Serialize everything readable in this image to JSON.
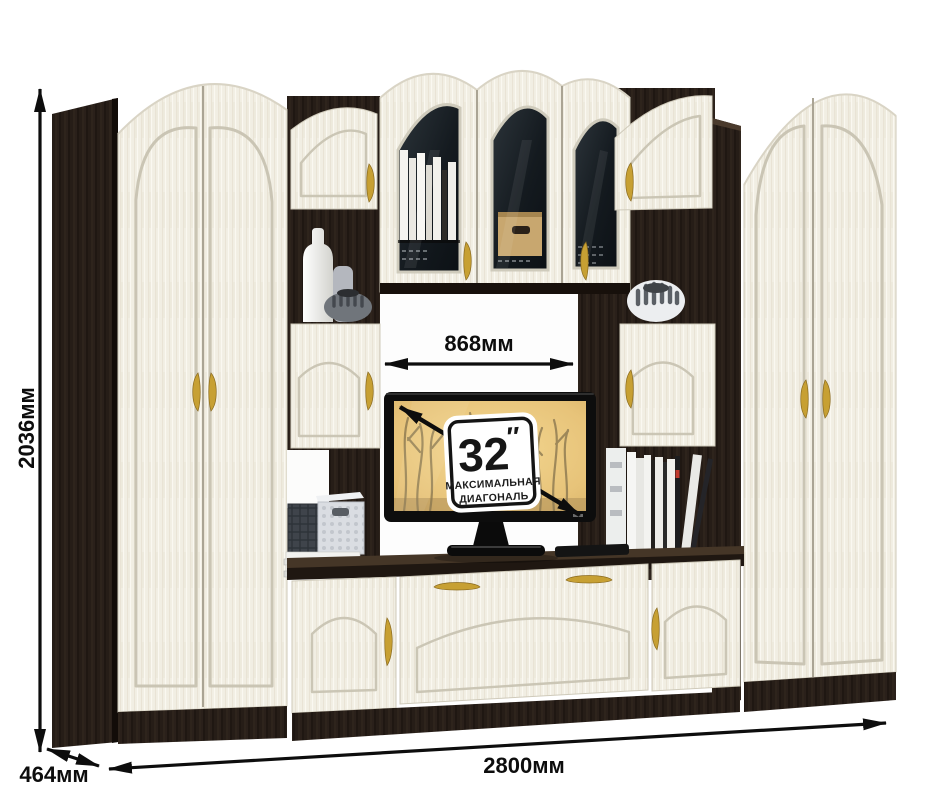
{
  "illustration": {
    "name": "wall-unit-dimension-diagram",
    "description": "3D render of a living-room wall unit (two wardrobes, glass display cabinet, TV niche, base cabinets) with dimension arrows",
    "colors": {
      "facade_cream": "#f1eee3",
      "carcass_wenge": "#261d17",
      "handle_gold": "#c7a033",
      "tv_screen_sepia": "#eecb82",
      "annotation_black": "#0d0d0d"
    }
  },
  "dimension_labels": {
    "height": "2036мм",
    "depth": "464мм",
    "width": "2800мм",
    "tv_niche_width": "868мм"
  },
  "tv_badge": {
    "diagonal_number": "32",
    "diagonal_prime": "″",
    "caption_line1": "МАКСИМАЛЬНАЯ",
    "caption_line2": "ДИАГОНАЛЬ"
  }
}
